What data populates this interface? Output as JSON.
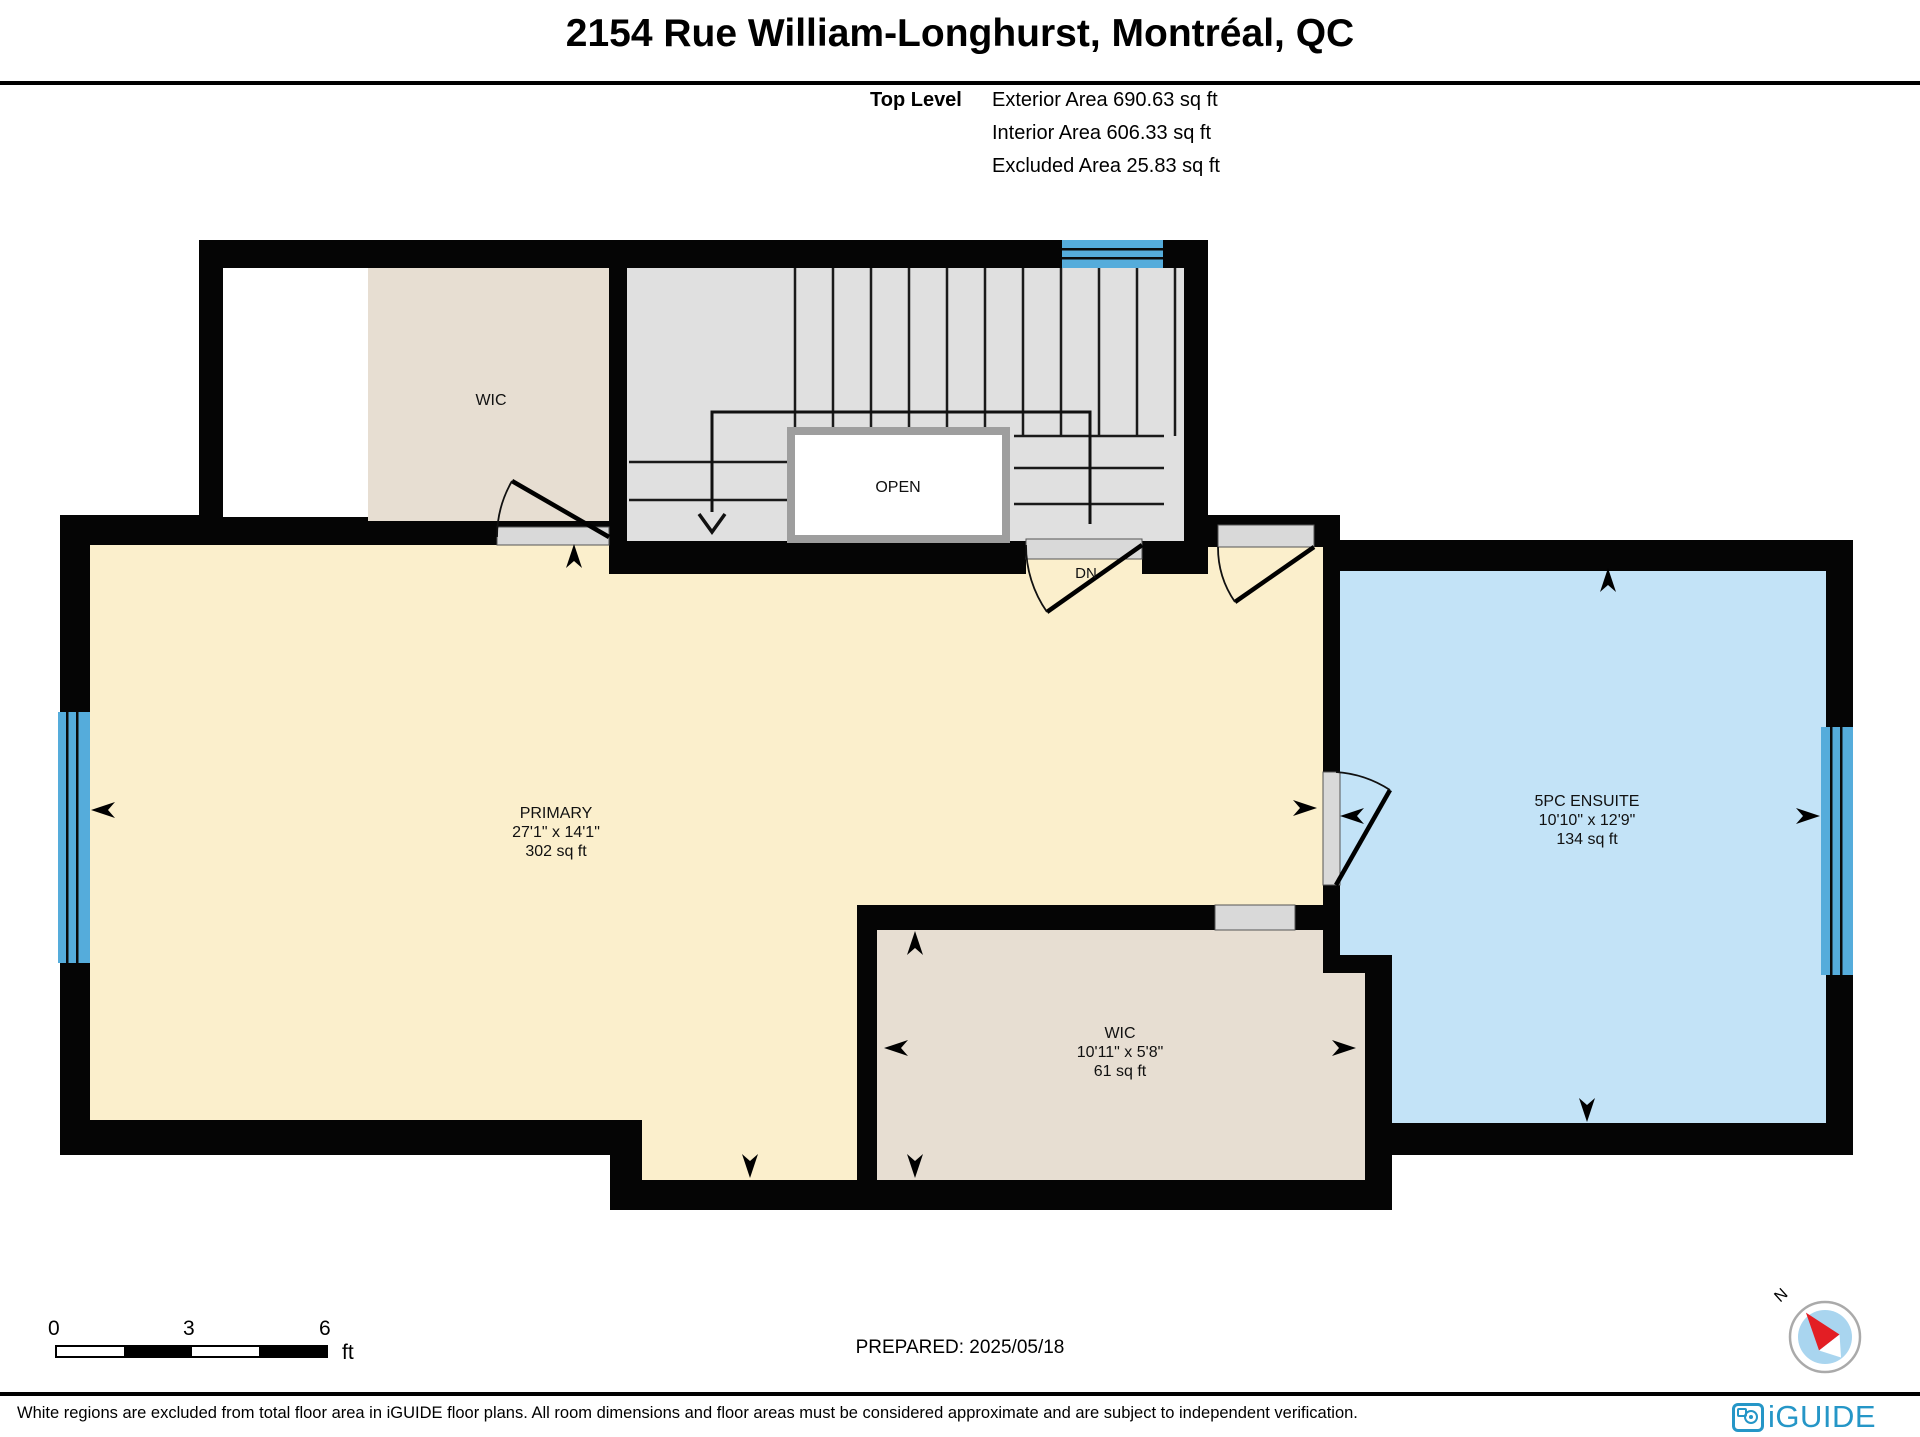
{
  "header": {
    "title": "2154 Rue William-Longhurst, Montréal, QC",
    "level_label": "Top Level",
    "areas": [
      "Exterior Area 690.63 sq ft",
      "Interior Area 606.33 sq ft",
      "Excluded Area 25.83 sq ft"
    ]
  },
  "rooms": {
    "wic_upper": {
      "name": "WIC"
    },
    "stairs": {
      "open_label": "OPEN",
      "dn_label": "DN"
    },
    "primary": {
      "name": "PRIMARY",
      "dims": "27'1\" x 14'1\"",
      "area": "302 sq ft"
    },
    "ensuite": {
      "name": "5PC ENSUITE",
      "dims": "10'10\" x 12'9\"",
      "area": "134 sq ft"
    },
    "wic_lower": {
      "name": "WIC",
      "dims": "10'11\" x 5'8\"",
      "area": "61 sq ft"
    }
  },
  "scale_bar": {
    "tick0": "0",
    "tick1": "3",
    "tick2": "6",
    "unit": "ft"
  },
  "prepared": "PREPARED: 2025/05/18",
  "compass": {
    "north_label": "N"
  },
  "footer": {
    "disclaimer": "White regions are excluded from total floor area in iGUIDE floor plans. All room dimensions and floor areas must be considered approximate and are subject to independent verification.",
    "brand": "iGUIDE"
  },
  "icons": {
    "compass": "north-arrow-icon",
    "brand": "camera-icon"
  },
  "colors": {
    "floor_primary": "#FBEFCC",
    "floor_wic": "#E7DED2",
    "floor_stairs": "#E0E0E0",
    "floor_ensuite": "#C3E3F7",
    "window_blue": "#55ACDB",
    "wall": "#050505",
    "threshold_gray": "#D9D9D9",
    "brand_blue": "#2596C7",
    "compass_red": "#E31E24",
    "compass_blue": "#A9D5EF"
  }
}
